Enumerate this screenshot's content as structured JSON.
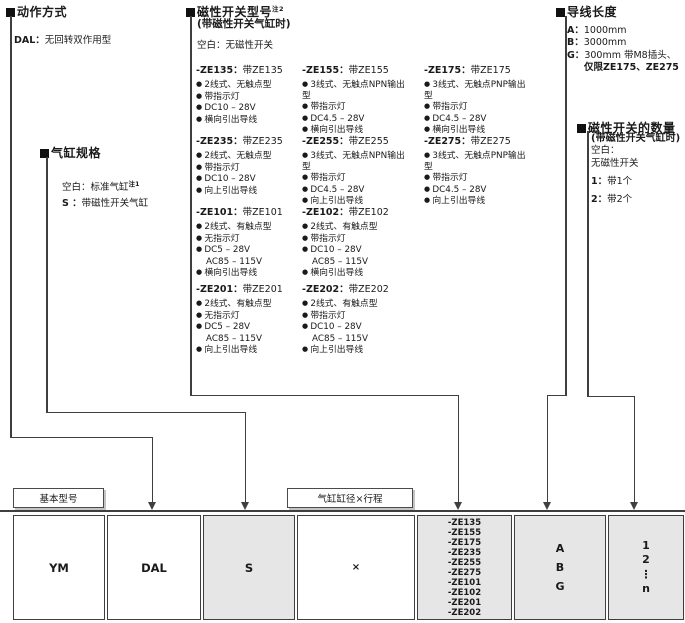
{
  "action_section": {
    "title": "动作方式",
    "item_code": "DAL：",
    "item_text": "无回转双作用型"
  },
  "spec_section": {
    "title": "气缸规格",
    "items": [
      {
        "code": "空白：",
        "text": "标准气缸",
        "sup": "注1"
      },
      {
        "code": "S ：",
        "text": "带磁性开关气缸",
        "sup": ""
      }
    ]
  },
  "switch_section": {
    "title": "磁性开关型号",
    "title_sup": "注2",
    "subtitle": "(带磁性开关气缸时)",
    "default_note": "空白：无磁性开关",
    "blocks": [
      {
        "code": "-ZE135：",
        "label": "带ZE135",
        "features": [
          {
            "t": "2线式、无触点型"
          },
          {
            "t": "带指示灯"
          },
          {
            "t": "DC10 – 28V"
          },
          {
            "t": "横向引出导线"
          }
        ]
      },
      {
        "code": "-ZE155：",
        "label": "带ZE155",
        "features": [
          {
            "t": "3线式、无触点NPN输出型"
          },
          {
            "t": "带指示灯"
          },
          {
            "t": "DC4.5 – 28V"
          },
          {
            "t": "横向引出导线"
          }
        ]
      },
      {
        "code": "-ZE175：",
        "label": "带ZE175",
        "features": [
          {
            "t": "3线式、无触点PNP输出型"
          },
          {
            "t": "带指示灯"
          },
          {
            "t": "DC4.5 – 28V"
          },
          {
            "t": "横向引出导线"
          }
        ]
      },
      {
        "code": "-ZE235：",
        "label": "带ZE235",
        "features": [
          {
            "t": "2线式、无触点型"
          },
          {
            "t": "带指示灯"
          },
          {
            "t": "DC10 – 28V"
          },
          {
            "t": "向上引出导线"
          }
        ]
      },
      {
        "code": "-ZE255：",
        "label": "带ZE255",
        "features": [
          {
            "t": "3线式、无触点NPN输出型"
          },
          {
            "t": "带指示灯"
          },
          {
            "t": "DC4.5 – 28V"
          },
          {
            "t": "向上引出导线"
          }
        ]
      },
      {
        "code": "-ZE275：",
        "label": "带ZE275",
        "features": [
          {
            "t": "3线式、无触点PNP输出型"
          },
          {
            "t": "带指示灯"
          },
          {
            "t": "DC4.5 – 28V"
          },
          {
            "t": "向上引出导线"
          }
        ]
      },
      {
        "code": "-ZE101：",
        "label": "带ZE101",
        "features": [
          {
            "t": "2线式、有触点型"
          },
          {
            "t": "无指示灯"
          },
          {
            "t": "DC5 – 28V"
          },
          {
            "t": "AC85 – 115V",
            "cont": true
          },
          {
            "t": "横向引出导线"
          }
        ]
      },
      {
        "code": "-ZE102：",
        "label": "带ZE102",
        "features": [
          {
            "t": "2线式、有触点型"
          },
          {
            "t": "带指示灯"
          },
          {
            "t": "DC10 – 28V"
          },
          {
            "t": "AC85 – 115V",
            "cont": true
          },
          {
            "t": "横向引出导线"
          }
        ]
      },
      {
        "code": "-ZE201：",
        "label": "带ZE201",
        "features": [
          {
            "t": "2线式、有触点型"
          },
          {
            "t": "无指示灯"
          },
          {
            "t": "DC5 – 28V"
          },
          {
            "t": "AC85 – 115V",
            "cont": true
          },
          {
            "t": "向上引出导线"
          }
        ]
      },
      {
        "code": "-ZE202：",
        "label": "带ZE202",
        "features": [
          {
            "t": "2线式、有触点型"
          },
          {
            "t": "带指示灯"
          },
          {
            "t": "DC10 – 28V"
          },
          {
            "t": "AC85 – 115V",
            "cont": true
          },
          {
            "t": "向上引出导线"
          }
        ]
      }
    ]
  },
  "lead_section": {
    "title": "导线长度",
    "items": [
      {
        "code": "A：",
        "text": "1000mm"
      },
      {
        "code": "B：",
        "text": "3000mm"
      },
      {
        "code": "G：",
        "text": "300mm 带M8插头、"
      },
      {
        "code": "",
        "text": "仅限ZE175、ZE275"
      }
    ]
  },
  "qty_section": {
    "title": "磁性开关的数量",
    "subtitle": "(带磁性开关气缸时)",
    "default_line1": "空白：",
    "default_line2": "无磁性开关",
    "items": [
      {
        "code": "1：",
        "text": "带1个"
      },
      {
        "code": "2：",
        "text": "带2个"
      }
    ]
  },
  "table": {
    "labels": {
      "basic_model": "基本型号",
      "bore_stroke": "气缸缸径×行程"
    },
    "cells": [
      {
        "id": "base",
        "lines": [
          "YM"
        ],
        "shaded": false
      },
      {
        "id": "action",
        "lines": [
          "DAL"
        ],
        "shaded": false
      },
      {
        "id": "spec",
        "lines": [
          "S"
        ],
        "shaded": true
      },
      {
        "id": "bore-stroke",
        "lines": [
          "×"
        ],
        "shaded": false
      },
      {
        "id": "switch-model",
        "lines": [
          "-ZE135",
          "-ZE155",
          "-ZE175",
          "-ZE235",
          "-ZE255",
          "-ZE275",
          "-ZE101",
          "-ZE102",
          "-ZE201",
          "-ZE202"
        ],
        "shaded": true
      },
      {
        "id": "lead-length",
        "lines": [
          "A",
          "B",
          "G"
        ],
        "shaded": true
      },
      {
        "id": "switch-qty",
        "lines": [
          "1",
          "2",
          "⋮",
          "n"
        ],
        "shaded": true
      }
    ]
  }
}
